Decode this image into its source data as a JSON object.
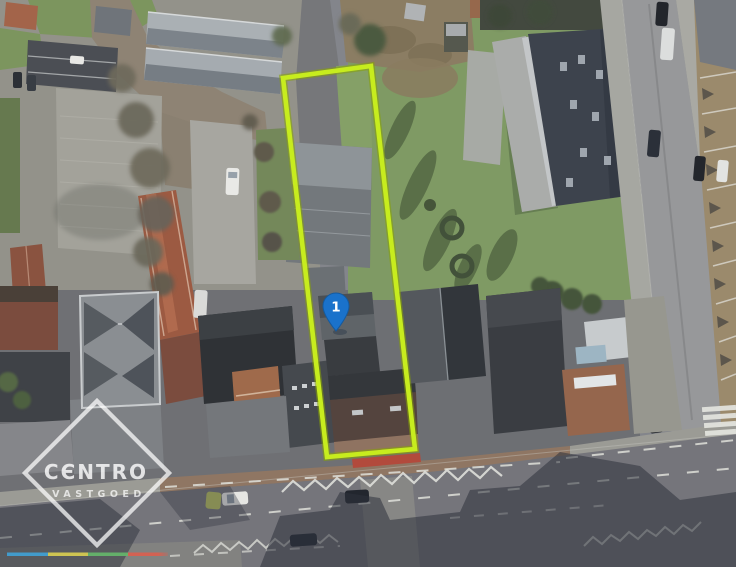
{
  "image": {
    "kind": "aerial-photograph",
    "alt": "Aerial photo of a building plot outlined in yellow-green with numbered location pin 1 and Centro Vastgoed watermark"
  },
  "parcel": {
    "outline_color": "#c7ec1e",
    "outline_shadow_color": "#86a303"
  },
  "marker": {
    "label": "1",
    "fill": "#1a72cb",
    "label_color": "#ffffff"
  },
  "watermark": {
    "brand": "CENTRO",
    "brand_display": "CЄNTRO",
    "tagline": "VASTGOED",
    "color": "#ffffff"
  },
  "brandbar": {
    "colors": [
      "#41a1d5",
      "#d9cd52",
      "#66b76c",
      "#d96050"
    ]
  }
}
